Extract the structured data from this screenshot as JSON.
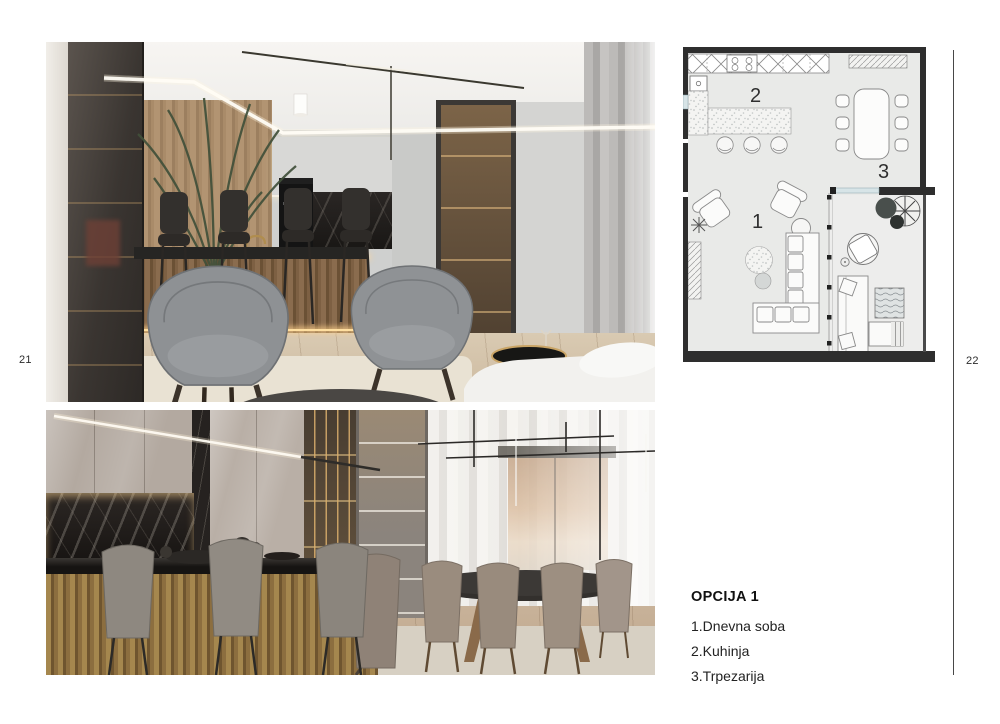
{
  "page": {
    "left_number": "21",
    "right_number": "22",
    "background": "#ffffff"
  },
  "legend": {
    "title": "OPCIJA 1",
    "items": [
      "1.Dnevna soba",
      "2.Kuhinja",
      "3.Trpezarija"
    ]
  },
  "floor_plan": {
    "labels": {
      "living_room": "1",
      "kitchen": "2",
      "dining": "3"
    },
    "wall_color": "#2e2e2e",
    "floor_color": "#e9eae8",
    "window_color": "#d7e4e7"
  }
}
